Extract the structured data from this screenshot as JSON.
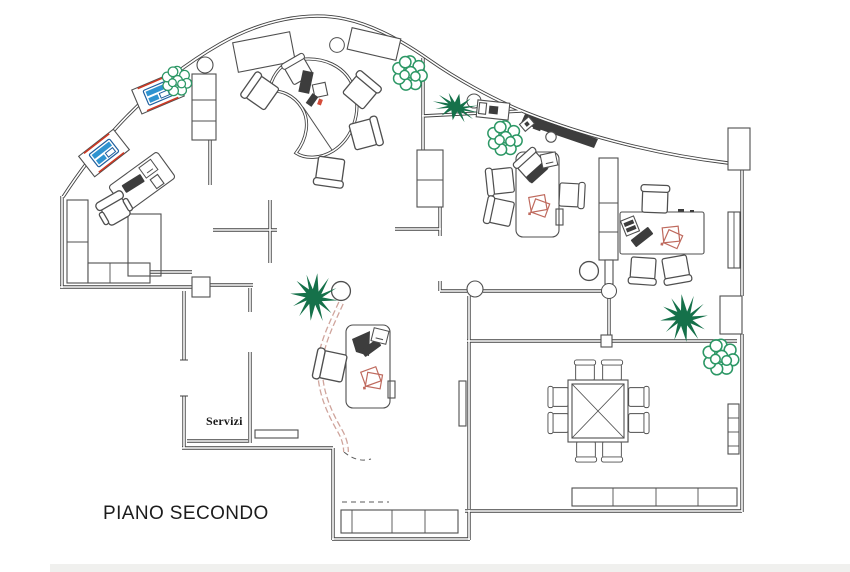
{
  "labels": {
    "floor_title": "PIANO SECONDO",
    "room_servizi": "Servizi"
  },
  "colors": {
    "bg": "#ffffff",
    "wall": "#414141",
    "line": "#4f4f4f",
    "dark": "#3d3d3d",
    "pgreen": "#15714a",
    "lgreen": "#2c9765",
    "blue": "#2f93d0",
    "dblue": "#1f5f9e",
    "red": "#cf3823",
    "paper": "#bf6a5e",
    "glass": "#cfa49c",
    "text": "#1c1c1c",
    "band": "#eaeae7"
  },
  "inventory": {
    "plants": [
      "palm-plant",
      "rosette-plant"
    ],
    "furniture": [
      "kidney-reception-desk",
      "workstation-desk",
      "visitor-chair",
      "task-chair",
      "conference-table",
      "wall-bench",
      "storage-cabinet",
      "sideboard",
      "printer",
      "copier",
      "radiator",
      "column",
      "glass-block-partition"
    ],
    "conference_seats": 8
  }
}
